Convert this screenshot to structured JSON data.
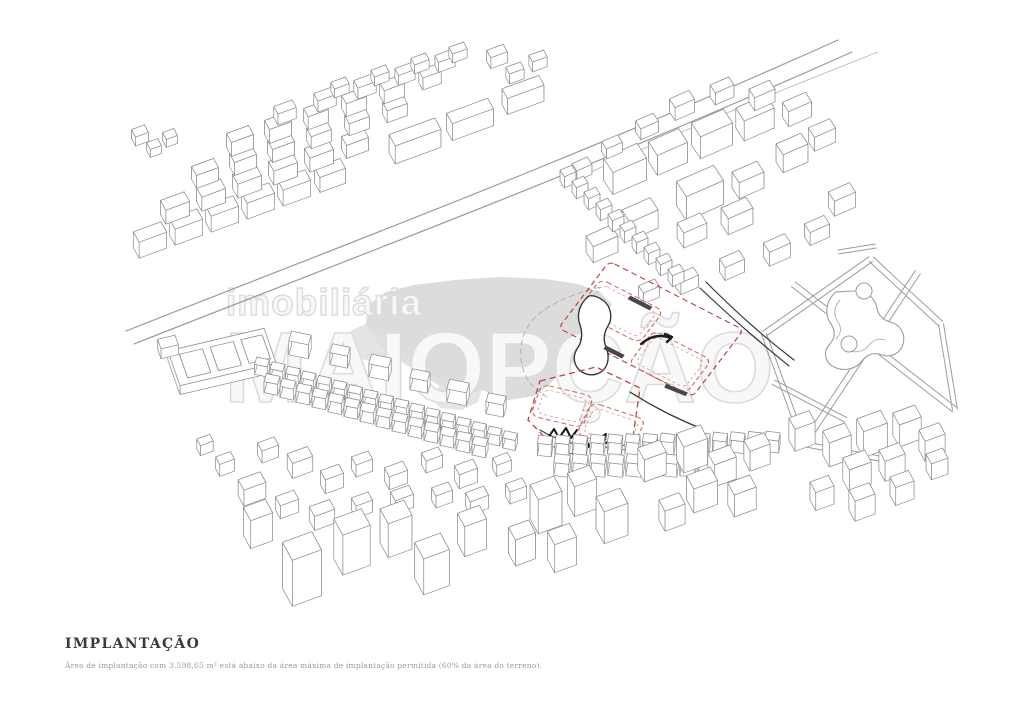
{
  "title_block": {
    "title": "IMPLANTAÇÃO",
    "caption": "Área de implantação com 3.598,65 m² está abaixo da área máxima de implantação permitida (60% da área do terreno)."
  },
  "watermark": {
    "line1": "imobiliária",
    "line2": "MAIOPÇÃO"
  },
  "colors": {
    "linework": "#8f8f8f",
    "light_linework": "#a8a8a8",
    "dark_linework": "#383838",
    "black_sketch": "#141414",
    "site_boundary_red": "#b8463c",
    "footprint_red": "#cd6a5f",
    "cloud_gray": "#d8d8d8",
    "watermark_gray": "#dcdcdc",
    "title_color": "#3a3a3a",
    "caption_color": "#9a9a9a",
    "background": "#ffffff"
  }
}
